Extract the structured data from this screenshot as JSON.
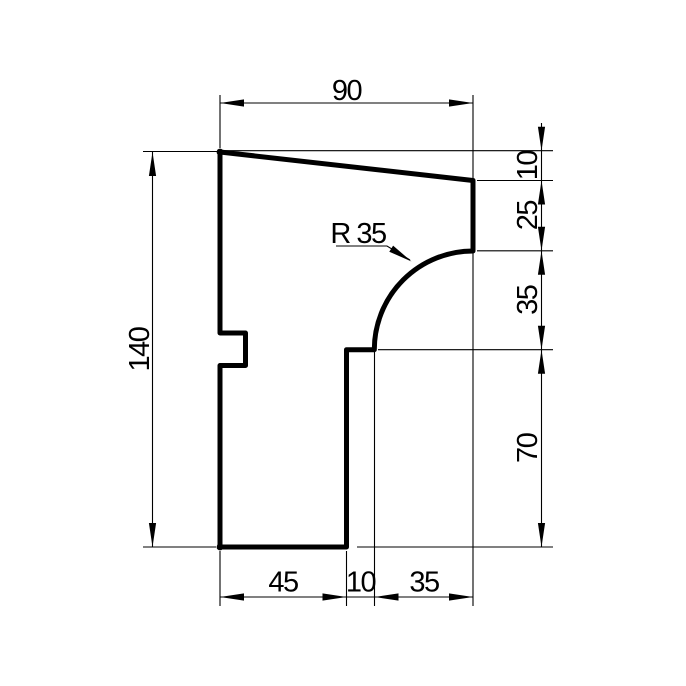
{
  "drawing": {
    "kind": "profile-cross-section-technical-drawing",
    "background_color": "#ffffff",
    "line_color": "#000000",
    "labels": {
      "top_width": "90",
      "left_height": "140",
      "right_10": "10",
      "right_25": "25",
      "right_35": "35",
      "right_70": "70",
      "bottom_45": "45",
      "bottom_10": "10",
      "bottom_35": "35",
      "radius": "R 35"
    }
  }
}
